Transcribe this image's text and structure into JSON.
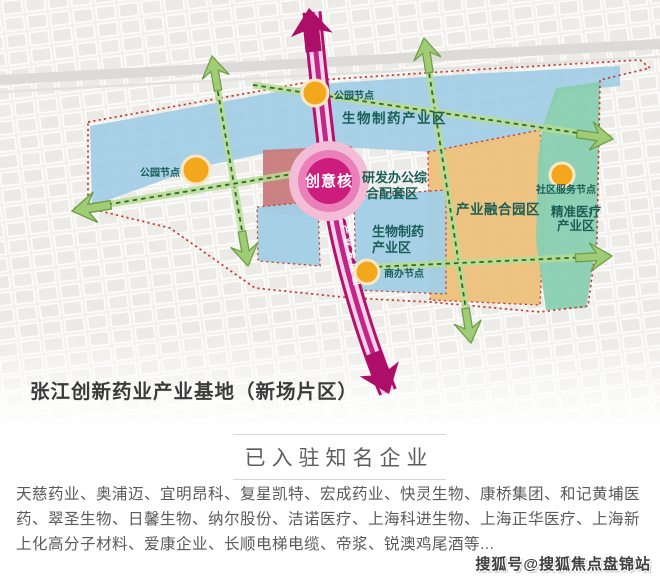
{
  "map": {
    "title": "张江创新药业产业基地（新场片区）",
    "zones": {
      "biopharma_top": "生物制药产业区",
      "rd_complex_l1": "研发办公综",
      "rd_complex_l2": "合配套区",
      "biopharma_lower_l1": "生物制药",
      "biopharma_lower_l2": "产业区",
      "industry_fusion": "产业融合园区",
      "precision_medical_l1": "精准医疗",
      "precision_medical_l2": "产业区"
    },
    "core_label": "创意核",
    "axis_label": "南北产业发展轴",
    "nodes": {
      "park_top": "公园节点",
      "park_left": "公园节点",
      "business": "商办节点",
      "community": "社区服务节点"
    },
    "colors": {
      "zone_blue": "#a3cfe6",
      "zone_orange": "#eec17c",
      "zone_teal": "#89cfb0",
      "zone_rose": "#c87b7c",
      "axis_magenta": "#b4116c",
      "axis_inner": "#f3d3e7",
      "corridor_green_band": "#b9dc92",
      "corridor_green_dash": "#2d6a2d",
      "arrow_green": "#9fcc74",
      "node_orange": "#f2a71d",
      "boundary_red": "#c43b2e",
      "label_teal": "#1a5f57"
    }
  },
  "section": {
    "header": "已入驻知名企业"
  },
  "companies": "天慈药业、奥浦迈、宜明昂科、复星凯特、宏成药业、快灵生物、康桥集团、和记黄埔医药、翠圣生物、日馨生物、纳尔股份、洁诺医疗、上海科进生物、上海正华医疗、上海新上化高分子材料、爱康企业、长顺电梯电缆、帝浆、锐澳鸡尾酒等...",
  "watermark": "搜狐号@搜狐焦点盘锦站"
}
